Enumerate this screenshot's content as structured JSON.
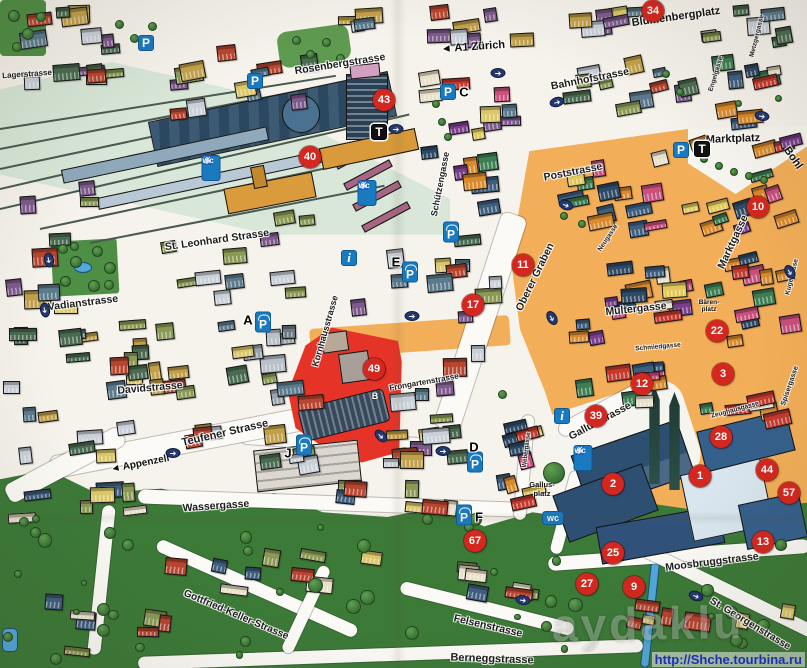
{
  "streets": [
    {
      "id": "lagerstrasse",
      "name": "Lagerstrasse"
    },
    {
      "id": "rosenbergstrasse",
      "name": "Rosenbergstrasse"
    },
    {
      "id": "bahnhofstrasse",
      "name": "Bahnhofstrasse"
    },
    {
      "id": "poststrasse",
      "name": "Poststrasse"
    },
    {
      "id": "stleonhard",
      "name": "St. Leonhard Strasse"
    },
    {
      "id": "schuetzengasse",
      "name": "Schützengasse"
    },
    {
      "id": "oberergraben",
      "name": "Oberer Graben"
    },
    {
      "id": "marktgasse",
      "name": "Marktgasse"
    },
    {
      "id": "multergasse",
      "name": "Multergasse"
    },
    {
      "id": "neugasse",
      "name": "Neugasse"
    },
    {
      "id": "kugelgasse",
      "name": "Kugelgasse"
    },
    {
      "id": "spisergasse",
      "name": "Spisergasse"
    },
    {
      "id": "metzgergasse",
      "name": "Metzgergasse"
    },
    {
      "id": "engelgasse",
      "name": "Engelgasse"
    },
    {
      "id": "vadianstrasse",
      "name": "Vadianstrasse"
    },
    {
      "id": "davidstrasse",
      "name": "Davidstrasse"
    },
    {
      "id": "kornhausstrasse",
      "name": "Kornhausstrasse"
    },
    {
      "id": "frongartenstrasse",
      "name": "Frongartenstrasse"
    },
    {
      "id": "teufener",
      "name": "Teufener Strasse"
    },
    {
      "id": "wassergasse",
      "name": "Wassergasse"
    },
    {
      "id": "gallusstrasse",
      "name": "Gallusstrasse"
    },
    {
      "id": "webergasse",
      "name": "Webergasse"
    },
    {
      "id": "zeughausgasse",
      "name": "Zeughausgasse"
    },
    {
      "id": "schmiedgasse",
      "name": "Schmiedgasse"
    },
    {
      "id": "moosbruggstrasse",
      "name": "Moosbruggstrasse"
    },
    {
      "id": "stgeorgen",
      "name": "St. Georgenstrasse"
    },
    {
      "id": "felsenstrasse",
      "name": "Felsenstrasse"
    },
    {
      "id": "berneggstrasse",
      "name": "Berneggstrasse"
    },
    {
      "id": "gottfriedkeller",
      "name": "Gottfried-Keller-Strasse"
    }
  ],
  "places": [
    {
      "id": "blumenbergplatz",
      "name": "Blumenbergplatz"
    },
    {
      "id": "marktplatz",
      "name": "Marktplatz"
    },
    {
      "id": "bohl",
      "name": "Bohl"
    },
    {
      "id": "baerenplatz",
      "name": "Bären-\nplatz"
    },
    {
      "id": "gallusplatz",
      "name": "Gallus-\nplatz"
    }
  ],
  "directions": [
    {
      "id": "a1",
      "arrow": "◄",
      "text": "A1 Zürich"
    },
    {
      "id": "appenzell",
      "arrow": "◄",
      "text": "Appenzell"
    }
  ],
  "poi_markers": [
    {
      "id": "poi-34",
      "number": "34"
    },
    {
      "id": "poi-43",
      "number": "43"
    },
    {
      "id": "poi-40",
      "number": "40"
    },
    {
      "id": "poi-11",
      "number": "11"
    },
    {
      "id": "poi-17",
      "number": "17"
    },
    {
      "id": "poi-10",
      "number": "10"
    },
    {
      "id": "poi-22",
      "number": "22"
    },
    {
      "id": "poi-12",
      "number": "12"
    },
    {
      "id": "poi-3",
      "number": "3"
    },
    {
      "id": "poi-39",
      "number": "39"
    },
    {
      "id": "poi-28",
      "number": "28"
    },
    {
      "id": "poi-44",
      "number": "44"
    },
    {
      "id": "poi-57",
      "number": "57"
    },
    {
      "id": "poi-1",
      "number": "1"
    },
    {
      "id": "poi-2",
      "number": "2"
    },
    {
      "id": "poi-49",
      "number": "49"
    },
    {
      "id": "poi-67",
      "number": "67"
    },
    {
      "id": "poi-25",
      "number": "25"
    },
    {
      "id": "poi-27",
      "number": "27"
    },
    {
      "id": "poi-9",
      "number": "9"
    },
    {
      "id": "poi-13",
      "number": "13"
    }
  ],
  "letter_markers": [
    {
      "id": "garage-a",
      "letter": "A"
    },
    {
      "id": "garage-b",
      "letter": "B"
    },
    {
      "id": "garage-c",
      "letter": "C"
    },
    {
      "id": "garage-d",
      "letter": "D"
    },
    {
      "id": "garage-e",
      "letter": "E"
    },
    {
      "id": "garage-f",
      "letter": "F"
    },
    {
      "id": "garage-j",
      "letter": "J"
    }
  ],
  "transit_markers": [
    {
      "id": "t-bahnhof",
      "letter": "T"
    },
    {
      "id": "t-marktplatz",
      "letter": "T"
    }
  ],
  "icons": {
    "parking": "P",
    "info": "i",
    "wc": "wc",
    "wheelchair": "♿",
    "oneway_arrow": "➔"
  },
  "watermark": {
    "ghost": "aydaklu",
    "url": "http://Shche.tourbina.ru"
  },
  "colors": {
    "poi_red": "#d3271f",
    "sign_blue": "#1a7ac0",
    "oneway_navy": "#23386e",
    "pedestrian_orange": "#f2ae58",
    "highlight_red": "#e63328",
    "park_green": "#4e8f45",
    "hill_green": "#3c7a38",
    "rail_mint": "#d8e7d8",
    "abbey_blue": "#2c4f72"
  }
}
